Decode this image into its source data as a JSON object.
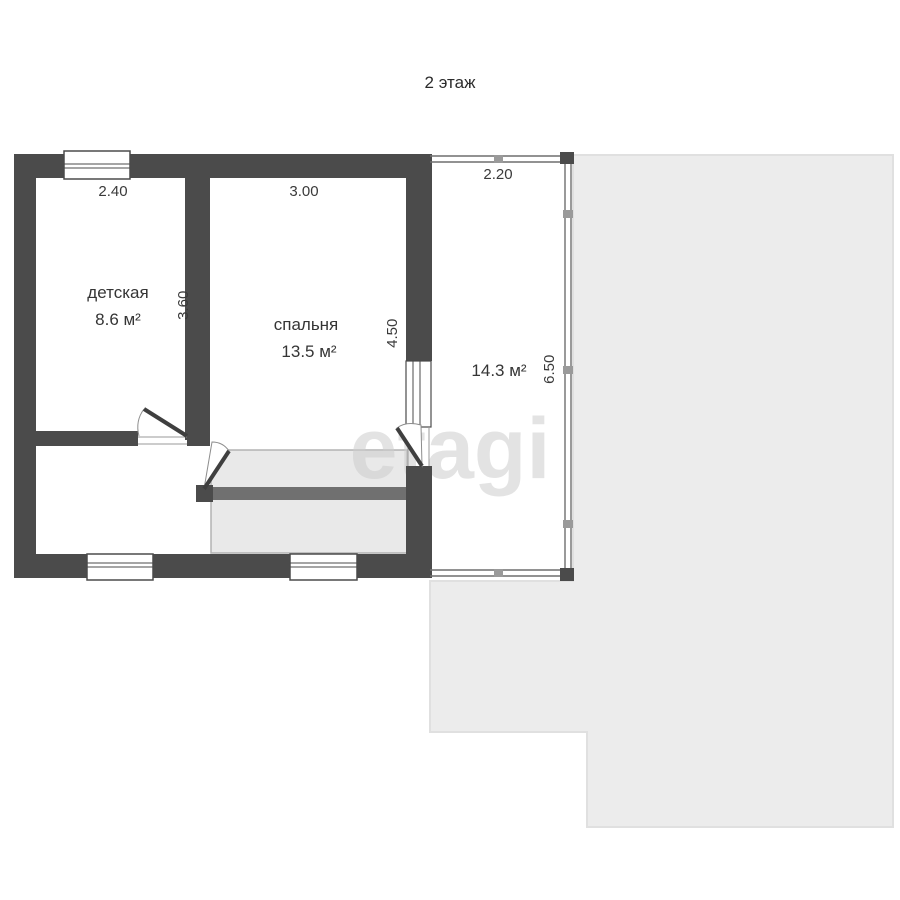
{
  "title": "2 этаж",
  "watermark_text": "etagi",
  "floor_plan": {
    "rooms": [
      {
        "name": "детская",
        "area": "8.6 м²",
        "width_m": "2.40",
        "height_m": "3.60"
      },
      {
        "name": "спальня",
        "area": "13.5 м²",
        "width_m": "3.00",
        "height_m": "4.50"
      },
      {
        "name": "",
        "area": "14.3 м²",
        "width_m": "2.20",
        "height_m": "6.50"
      }
    ],
    "colors": {
      "wall": "#4b4b4b",
      "roof_area": "#ececec",
      "roof_border": "#e0e0e0",
      "stair_fill": "#e9e9e9",
      "stair_border": "#b3b3b3",
      "stair_band": "#707070",
      "thin_line": "#8d8d8d",
      "watermark": "#cdcdcd"
    }
  }
}
